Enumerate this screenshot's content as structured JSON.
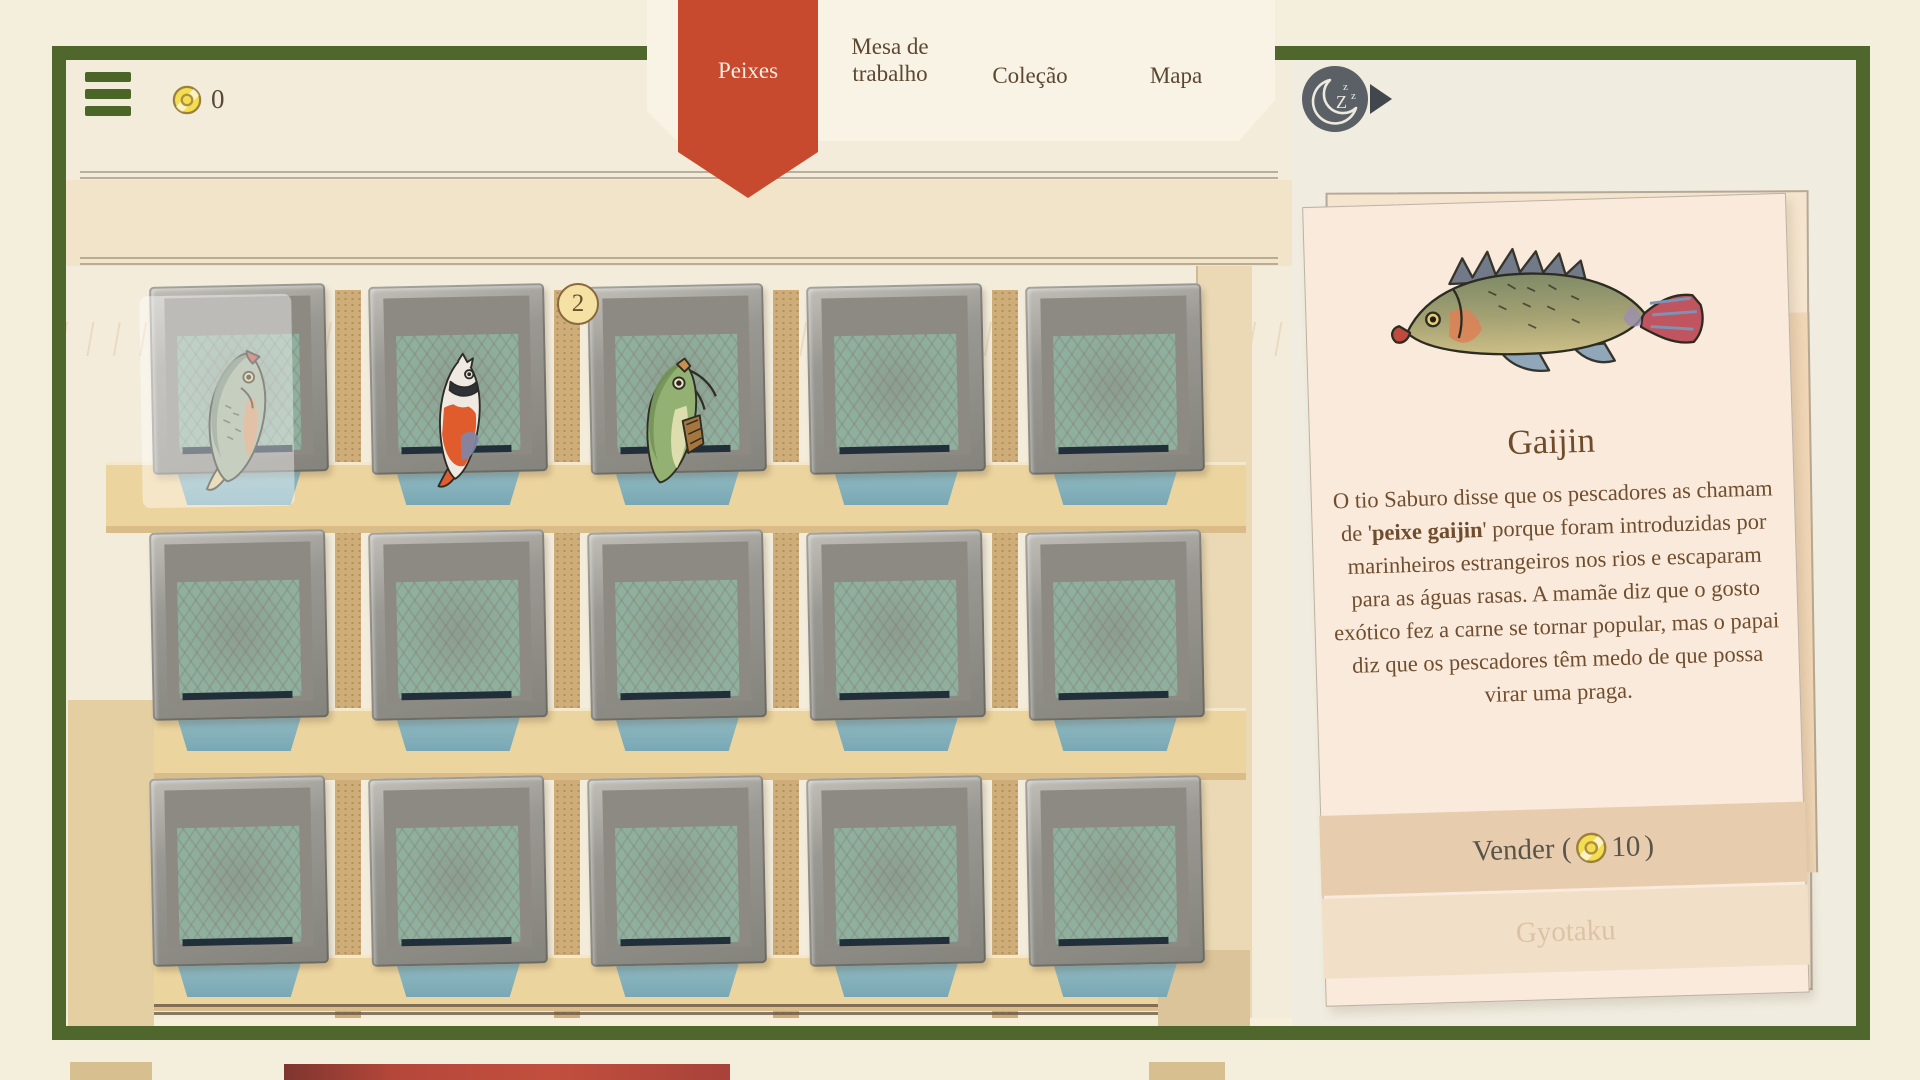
{
  "header": {
    "coins": "0",
    "tabs": [
      {
        "label": "Peixes",
        "active": true
      },
      {
        "label": "Mesa de trabalho",
        "active": false
      },
      {
        "label": "Coleção",
        "active": false
      },
      {
        "label": "Mapa",
        "active": false
      }
    ]
  },
  "shelf": {
    "rows": 3,
    "cols": 5,
    "trays": [
      {
        "fish": "gaijin",
        "selected": true
      },
      {
        "fish": "koi"
      },
      {
        "fish": "catfish",
        "count": "2"
      },
      {},
      {},
      {},
      {},
      {},
      {},
      {},
      {},
      {},
      {},
      {},
      {}
    ]
  },
  "detail_card": {
    "title": "Gaijin",
    "description_pre": "O tio Saburo disse que os pescadores as chamam de '",
    "description_bold": "peixe gaijin",
    "description_post": "' porque foram introduzidas por marinheiros estrangeiros nos rios e escaparam para as águas rasas. A mamãe diz que o gosto exótico fez a carne se tornar popular, mas o papai diz que os pescadores têm medo de que possa virar uma praga.",
    "sell_label_pre": "Vender (",
    "sell_price": "10",
    "sell_label_post": ")",
    "gyotaku_label": "Gyotaku"
  },
  "colors": {
    "frame_green": "#4f672c",
    "ribbon_red": "#c7492e",
    "coin_yellow": "#f2de4e",
    "card_peach": "#f9eadb",
    "water_teal": "#8fb09f",
    "text_brown": "#6f4d2e"
  }
}
